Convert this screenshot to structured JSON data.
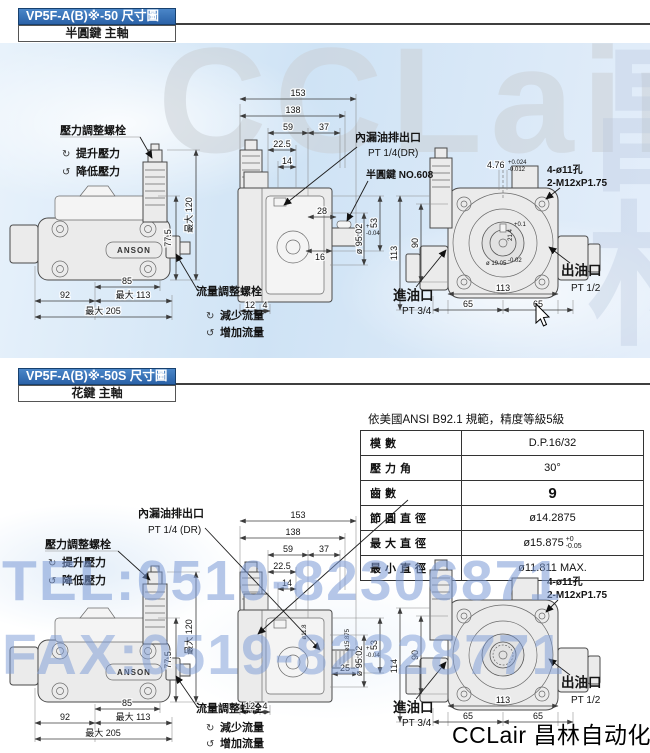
{
  "colors": {
    "header_blue": "#2f6db8",
    "watermark_blue": "#7a99d6",
    "drawing_bg_blue": "#d9e9f7",
    "line_gray": "#3c3c3c"
  },
  "page": {
    "watermark_brand": "CCLair",
    "watermark_cn": "昌林自动化",
    "watermark_tel": "TEL:0510-82306871",
    "watermark_fax": "FAX:0519-82328771",
    "footer_brand": "CCLair 昌林自动化",
    "icons": {
      "cw": "↻",
      "ccw": "↺"
    }
  },
  "section1": {
    "title": "VP5F-A(B)※-50 尺寸圖",
    "subtitle": "半圓鍵 主軸",
    "front": {
      "brand": "ANSON",
      "pressure_adjust": "壓力調整螺栓",
      "raise_pressure": "提升壓力",
      "lower_pressure": "降低壓力",
      "flow_adjust": "流量調整螺栓",
      "decrease_flow": "減少流量",
      "increase_flow": "增加流量",
      "dim_85": "85",
      "dim_92": "92",
      "dim_max113": "最大 113",
      "dim_max205": "最大 205",
      "dim_77_5": "77.5",
      "dim_max120": "最大 120"
    },
    "side": {
      "drain_label": "內漏油排出口",
      "drain_port": "PT 1/4(DR)",
      "key_label": "半圓鍵 NO.608",
      "dim_153": "153",
      "dim_138": "138",
      "dim_59": "59",
      "dim_37": "37",
      "dim_22_5": "22.5",
      "dim_14": "14",
      "dim_28": "28",
      "dim_16": "16",
      "dim_12": "12",
      "dim_4": "4",
      "dim_pilot": "ø 95.02",
      "pilot_tol_top": "+0",
      "pilot_tol_bot": "-0.04",
      "dim_53": "53"
    },
    "rear": {
      "dim_4_76": "4.76",
      "tol_4_76_top": "+0.024",
      "tol_4_76_bot": "-0.012",
      "holes": "4-ø11孔",
      "thread": "2-M12xP1.75",
      "dim_113_v": "113",
      "dim_90": "90",
      "dim_21_4": "21.4",
      "tol_21_4": "+0.1",
      "dim_19_05": "ø 19.05",
      "tol_19_05": "-0.02",
      "dim_113": "113",
      "dim_65_left": "65",
      "dim_65_right": "65",
      "inlet": "進油口",
      "inlet_port": "PT 3/4",
      "outlet": "出油口",
      "outlet_port": "PT 1/2"
    }
  },
  "section2": {
    "title": "VP5F-A(B)※-50S 尺寸圖",
    "subtitle": "花鍵 主軸",
    "spline_table": {
      "note": "依美國ANSI B92.1 規範，精度等級5級",
      "rows": [
        {
          "label": "模數",
          "value": "D.P.16/32"
        },
        {
          "label": "壓力角",
          "value": "30°"
        },
        {
          "label": "齒數",
          "value": "9"
        },
        {
          "label": "節圓直徑",
          "value": "ø14.2875"
        },
        {
          "label": "最大直徑",
          "value": "ø15.875",
          "tol_top": "+0",
          "tol_bot": "-0.05"
        },
        {
          "label": "最小直徑",
          "value": "ø11.811 MAX."
        }
      ]
    },
    "front": {
      "brand": "ANSON",
      "pressure_adjust": "壓力調整螺栓",
      "raise_pressure": "提升壓力",
      "lower_pressure": "降低壓力",
      "flow_adjust": "流量調整螺栓",
      "decrease_flow": "減少流量",
      "increase_flow": "增加流量",
      "dim_85": "85",
      "dim_92": "92",
      "dim_max113": "最大 113",
      "dim_max205": "最大 205",
      "dim_77_5": "77.5",
      "dim_max120": "最大 120"
    },
    "side": {
      "drain_label": "內漏油排出口",
      "drain_port": "PT 1/4 (DR)",
      "dim_153": "153",
      "dim_138": "138",
      "dim_59": "59",
      "dim_37": "37",
      "dim_22_5": "22.5",
      "dim_14": "14",
      "dim_25": "25",
      "dim_12": "12",
      "dim_4": "4",
      "dim_spline_od": "ø15.875",
      "dim_spline_id": "ø11.8",
      "dim_pilot": "ø 95.02",
      "pilot_tol_top": "+0",
      "pilot_tol_bot": "-0.04",
      "dim_53": "53"
    },
    "rear": {
      "holes": "4-ø11孔",
      "thread": "2-M12xP1.75",
      "dim_114": "114",
      "dim_90": "90",
      "dim_113": "113",
      "dim_65_left": "65",
      "dim_65_right": "65",
      "inlet": "進油口",
      "inlet_port": "PT 3/4",
      "outlet": "出油口",
      "outlet_port": "PT 1/2"
    }
  }
}
